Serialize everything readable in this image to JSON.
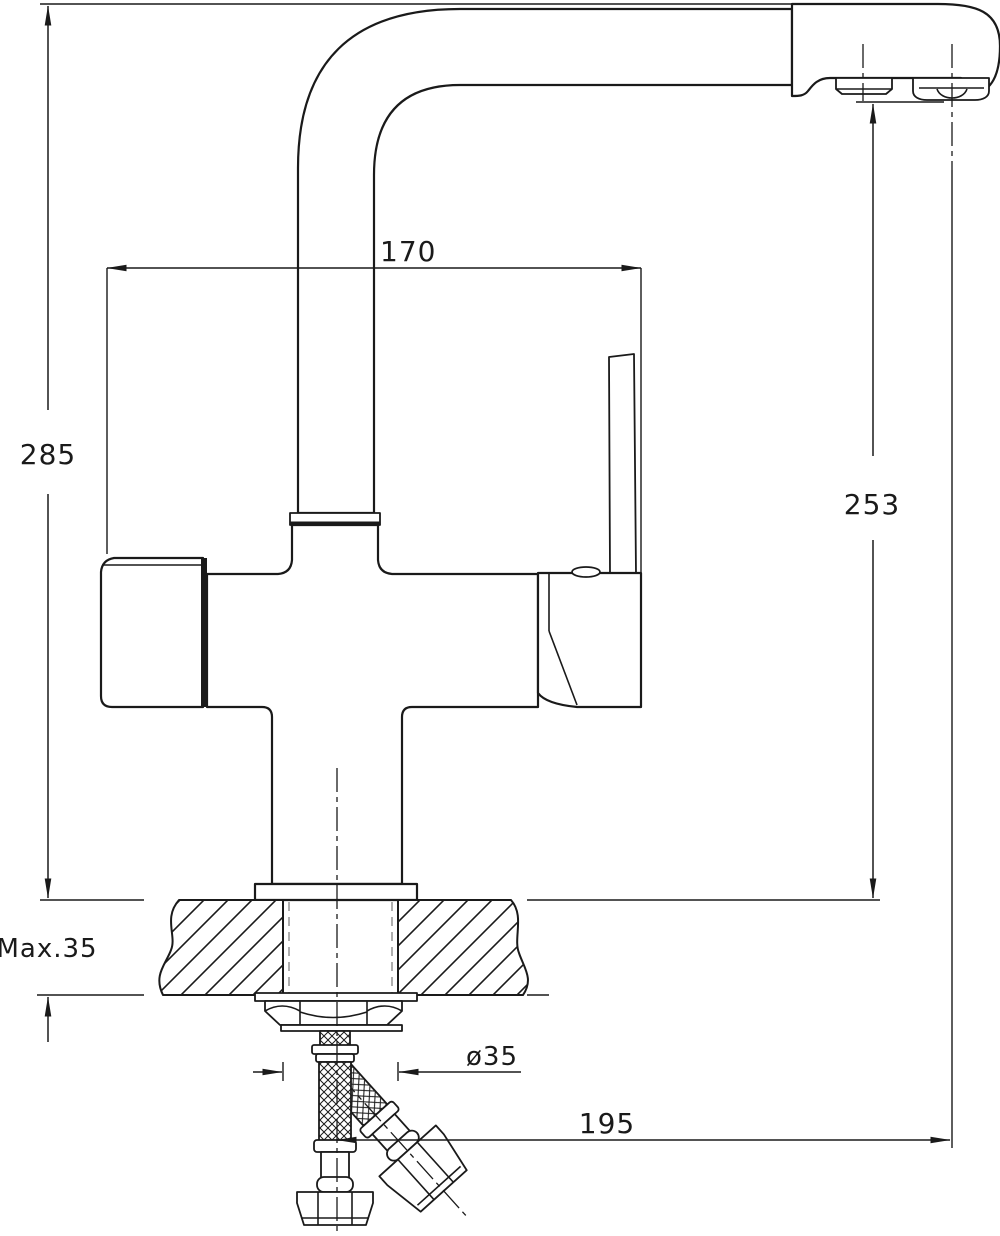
{
  "drawing": {
    "title": "Kitchen faucet installation dimension drawing (side view)",
    "type": "technical-dimension-drawing",
    "colors": {
      "line": "#1a1a1a",
      "background": "#ffffff",
      "thread_dash": "#9a9a9a"
    },
    "labels": {
      "spout_reach": "170",
      "overall_height": "285",
      "outlet_height": "253",
      "deck_thickness": "Max.35",
      "hole_diameter": "ø35",
      "outlet_reach": "195"
    }
  }
}
